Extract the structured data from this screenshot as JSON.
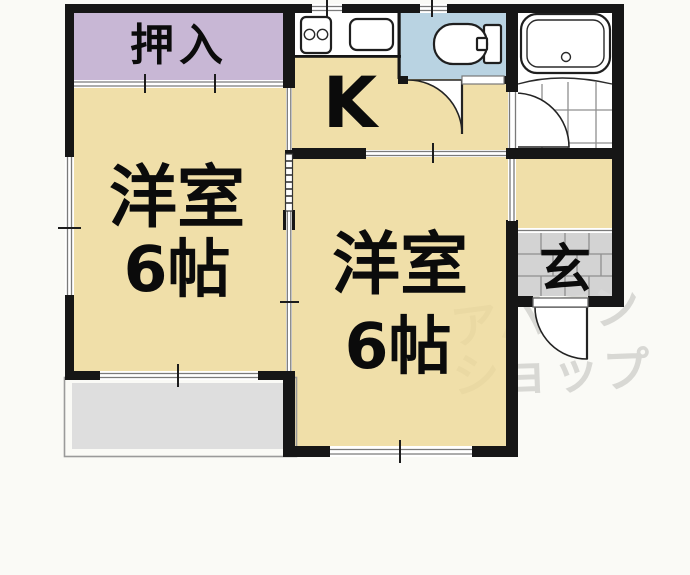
{
  "plan": {
    "type": "japanese-apartment-floor-plan",
    "rooms": {
      "closet": {
        "label": "押入"
      },
      "western_room_1": {
        "label": "洋室",
        "size": "6帖"
      },
      "western_room_2": {
        "label": "洋室",
        "size": "6帖"
      },
      "kitchen": {
        "label": "K"
      },
      "entrance": {
        "label": "玄"
      }
    },
    "fixture_icons": [
      "bathtub-icon",
      "toilet-icon",
      "kitchen-sink-icon",
      "stove-burners-icon",
      "balcony",
      "entry-tile-floor"
    ],
    "colors": {
      "room_tan": "#F0DFA9",
      "closet_purple": "#C8B7D5",
      "toilet_blue": "#B9D3E2",
      "entrance_gray": "#D3D3D3",
      "balcony_gray": "#DEDEDE",
      "wall_black": "#161616",
      "background": "#FAFAF6",
      "watermark_gray": "#D8D8D8"
    }
  },
  "watermark": {
    "line1": "アパマン",
    "line2": "ショップ"
  }
}
